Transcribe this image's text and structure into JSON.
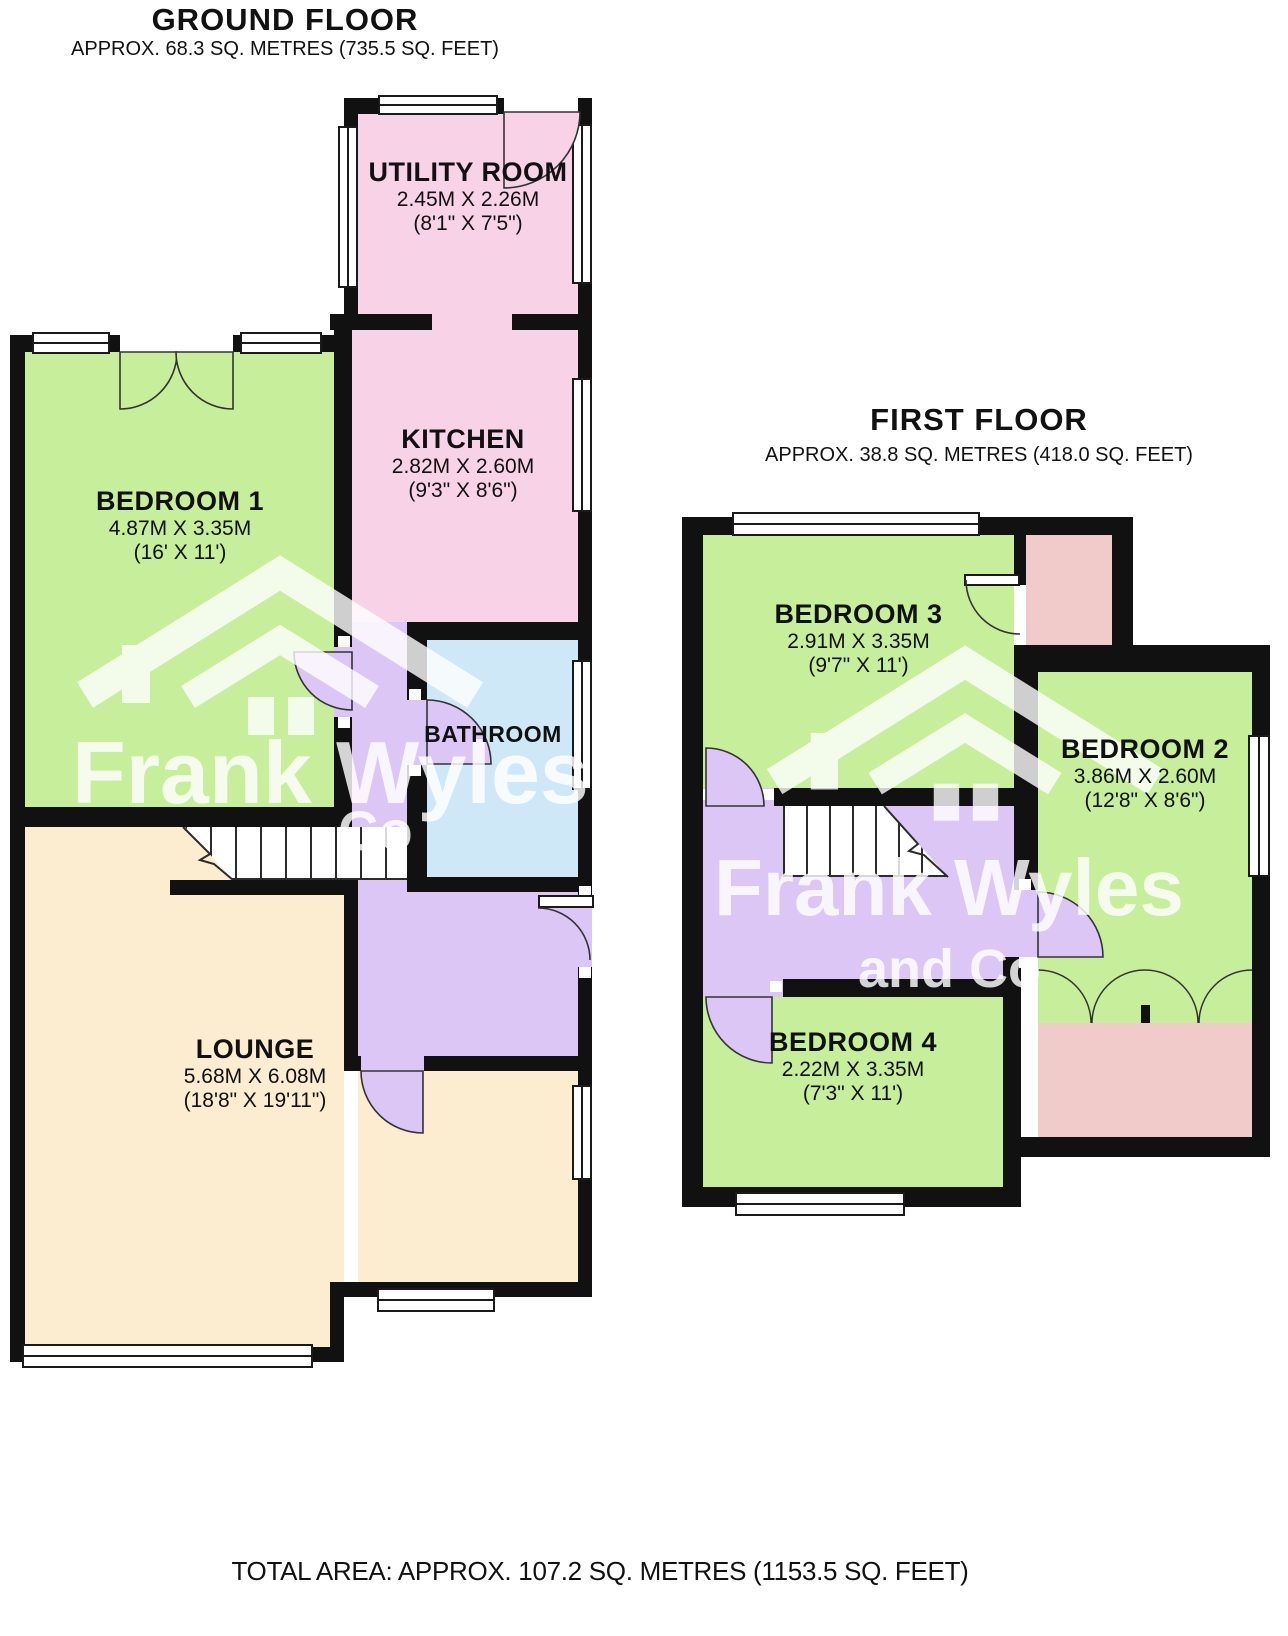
{
  "ground_floor": {
    "title": "GROUND FLOOR",
    "subtitle": "APPROX. 68.3 SQ. METRES (735.5 SQ. FEET)",
    "rooms": {
      "utility": {
        "name": "UTILITY ROOM",
        "dims_m": "2.45M X 2.26M",
        "dims_i": "(8'1\" X 7'5\")"
      },
      "kitchen": {
        "name": "KITCHEN",
        "dims_m": "2.82M X 2.60M",
        "dims_i": "(9'3\" X 8'6\")"
      },
      "bedroom1": {
        "name": "BEDROOM 1",
        "dims_m": "4.87M X 3.35M",
        "dims_i": "(16' X 11')"
      },
      "bathroom": {
        "name": "BATHROOM"
      },
      "lounge": {
        "name": "LOUNGE",
        "dims_m": "5.68M X 6.08M",
        "dims_i": "(18'8\" X 19'11\")"
      }
    }
  },
  "first_floor": {
    "title": "FIRST FLOOR",
    "subtitle": "APPROX. 38.8 SQ. METRES (418.0 SQ. FEET)",
    "rooms": {
      "bedroom3": {
        "name": "BEDROOM 3",
        "dims_m": "2.91M X 3.35M",
        "dims_i": "(9'7\" X 11')"
      },
      "bedroom2": {
        "name": "BEDROOM 2",
        "dims_m": "3.86M X 2.60M",
        "dims_i": "(12'8\" X 8'6\")"
      },
      "bedroom4": {
        "name": "BEDROOM 4",
        "dims_m": "2.22M X 3.35M",
        "dims_i": "(7'3\" X 11')"
      }
    }
  },
  "footer": {
    "total": "TOTAL AREA: APPROX. 107.2 SQ. METRES (1153.5 SQ. FEET)"
  },
  "watermark": {
    "brand": "Frank Wyles",
    "suffix": "and Co",
    "suffix_short": "Co"
  },
  "colors": {
    "wall": "#111111",
    "green": "#c7ee9a",
    "pink": "#f8d2e7",
    "salmon": "#f0cbc9",
    "blue": "#cfe8f7",
    "lavender": "#dcc6f6",
    "peach": "#fcecd0"
  }
}
